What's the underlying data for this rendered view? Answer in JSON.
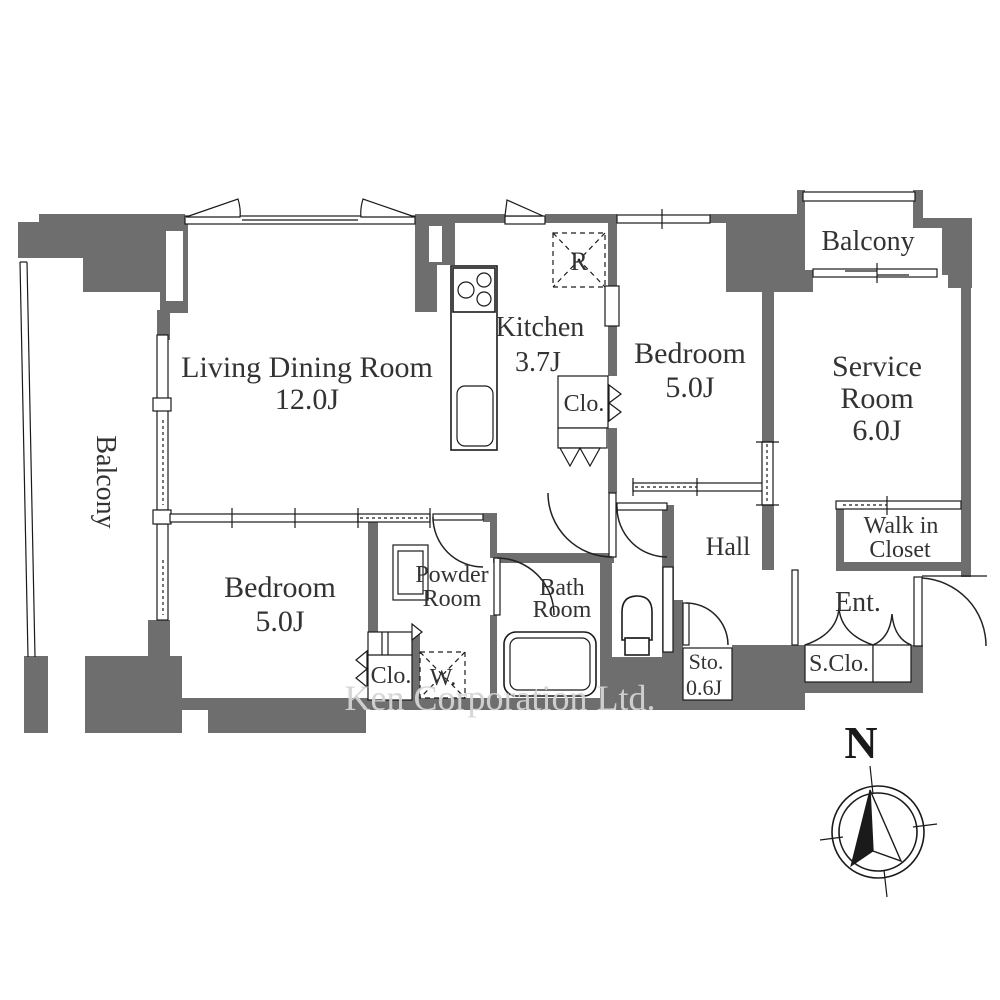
{
  "floor_plan": {
    "watermark": "Ken Corporation Ltd.",
    "compass": {
      "north_label": "N"
    },
    "colors": {
      "wall": "#6e6e6e",
      "line": "#1a1a1a",
      "label": "#333333",
      "watermark": "#d4d4d4"
    },
    "rooms": {
      "living_dining": {
        "name": "Living Dining Room",
        "size": "12.0J"
      },
      "kitchen": {
        "name": "Kitchen",
        "size": "3.7J"
      },
      "bedroom_north": {
        "name": "Bedroom",
        "size": "5.0J"
      },
      "bedroom_west": {
        "name": "Bedroom",
        "size": "5.0J"
      },
      "service_room": {
        "name_line1": "Service",
        "name_line2": "Room",
        "size": "6.0J"
      },
      "balcony_west": {
        "name": "Balcony"
      },
      "balcony_northeast": {
        "name": "Balcony"
      },
      "walk_in_closet": {
        "name_line1": "Walk in",
        "name_line2": "Closet"
      },
      "hall": {
        "name": "Hall"
      },
      "powder_room": {
        "name_line1": "Powder",
        "name_line2": "Room"
      },
      "bath_room": {
        "name_line1": "Bath",
        "name_line2": "Room"
      },
      "entrance": {
        "name": "Ent."
      },
      "storage": {
        "name": "Sto.",
        "size": "0.6J"
      },
      "shoe_closet": {
        "name": "S.Clo."
      },
      "closet_kitchen_side": {
        "name": "Clo."
      },
      "closet_bedroom_west": {
        "name": "Clo."
      }
    },
    "fixtures": {
      "refrigerator": "R",
      "washing_machine": "W."
    }
  }
}
